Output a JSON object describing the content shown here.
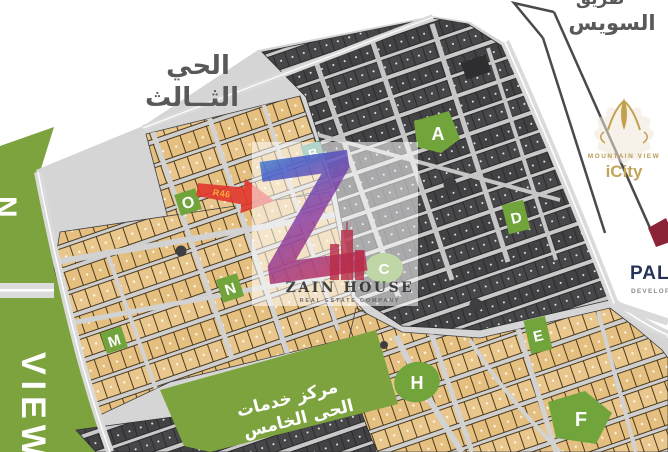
{
  "map": {
    "colors": {
      "area_green": "#7da33e",
      "label_green": "#72a43c",
      "plot_tan": "#e5bf80",
      "plot_dark": "#424245",
      "road_gray": "#d5d5d5",
      "marker_red": "#e2382c",
      "marker_code_color": "#ffaa33",
      "heading_gray": "#58595b",
      "palm_navy": "#253457",
      "palm_maroon": "#8c2438",
      "gold": "#c2a558"
    },
    "district_label": {
      "line1": "الحي",
      "line2": "الثــالث"
    },
    "highway": {
      "partial_word": "طريق",
      "label": "السويس"
    },
    "services_center": {
      "line1": "مركز خدمات",
      "line2": "الحى الخامس"
    },
    "left_strip": {
      "partial_letter": "N",
      "label": "VIEW"
    },
    "block_labels": {
      "a": "A",
      "b": "B",
      "c": "C",
      "d": "D",
      "e": "E",
      "f": "F",
      "h": "H",
      "m": "M",
      "n": "N",
      "o": "O"
    },
    "marker": {
      "code": "R46"
    }
  },
  "watermark": {
    "letter": "Z",
    "brand": "ZAIN HOUSE",
    "subtitle": "REAL ESTATE COMPANY"
  },
  "logos": {
    "mountain_view": {
      "line1": "MOUNTAIN VIEW",
      "line2": "iCity"
    },
    "palm": {
      "name": "PALM",
      "subtitle": "DEVELOPMENTS"
    }
  }
}
